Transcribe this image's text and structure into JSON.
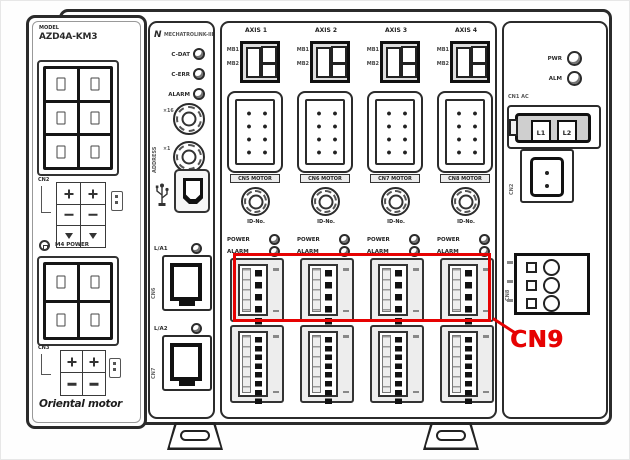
{
  "colors": {
    "line": "#2b2b2b",
    "dark": "#101010",
    "accent_red": "#e60202",
    "fill_light": "#ededed"
  },
  "left_module": {
    "model_label": "MODEL",
    "model_number": "AZD4A-KM3",
    "cn2_label": "CN2",
    "cn3_label": "CN3",
    "ground_label": "M4 POWER",
    "brand": "Oriental motor"
  },
  "comm_panel": {
    "logo": "N",
    "logo_text": "MECHATROLINK-III",
    "leds": [
      {
        "label": "C-DAT"
      },
      {
        "label": "C-ERR"
      },
      {
        "label": "ALARM"
      }
    ],
    "address_label": "ADDRESS",
    "switch_marks": [
      "×16",
      "×1"
    ],
    "lan1_label": "L/A1",
    "lan2_label": "L/A2",
    "lan1_cn": "CN6",
    "lan2_cn": "CN7"
  },
  "axes": {
    "brake_labels": [
      "MB1",
      "MB2"
    ],
    "id_label": "ID-No.",
    "power_label": "POWER",
    "alarm_label": "ALARM",
    "columns": [
      {
        "label": "AXIS 1",
        "motor_label": "CN5 MOTOR"
      },
      {
        "label": "AXIS 2",
        "motor_label": "CN6 MOTOR"
      },
      {
        "label": "AXIS 3",
        "motor_label": "CN7 MOTOR"
      },
      {
        "label": "AXIS 4",
        "motor_label": "CN8 MOTOR"
      }
    ]
  },
  "right_panel": {
    "pwr_label": "PWR",
    "alm_label": "ALM",
    "ac_label": "CN1 AC",
    "ac_terminals": [
      "L1",
      "L2"
    ],
    "cn2_label": "CN2",
    "cn8_label": "CN8"
  },
  "annotation": {
    "label": "CN9"
  }
}
